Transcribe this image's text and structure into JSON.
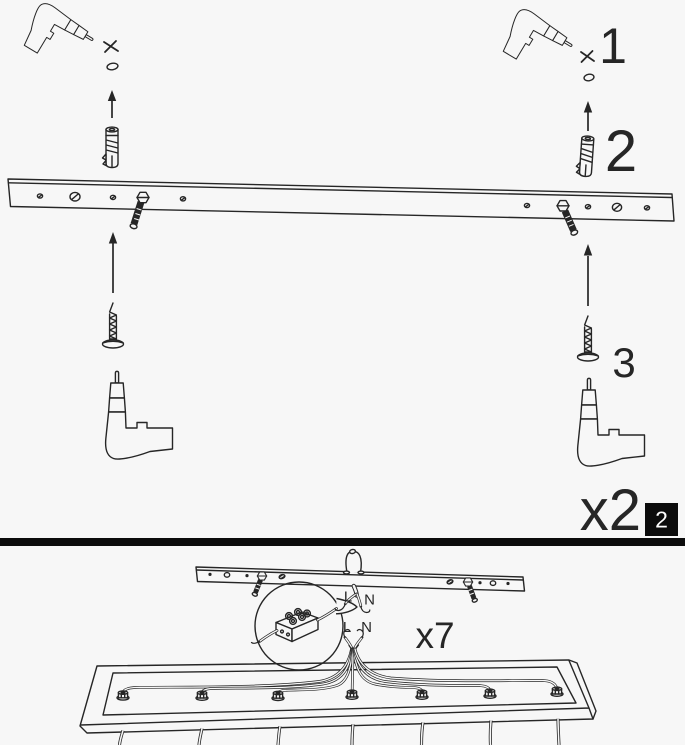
{
  "colors": {
    "paper": "#f7f7f7",
    "ink": "#262626",
    "badge_background": "#0c0c0c",
    "badge_text": "#ffffff"
  },
  "panel_mounting": {
    "steps": {
      "drill_hole": "1",
      "insert_wall_plug": "2",
      "fasten_screw": "3"
    },
    "quantity": "x2",
    "page_badge": "2"
  },
  "panel_wiring": {
    "quantity": "x7",
    "mains_wires": {
      "live": "L",
      "neutral": "N"
    },
    "fixture_wires": {
      "live": "L",
      "neutral": "N"
    }
  }
}
